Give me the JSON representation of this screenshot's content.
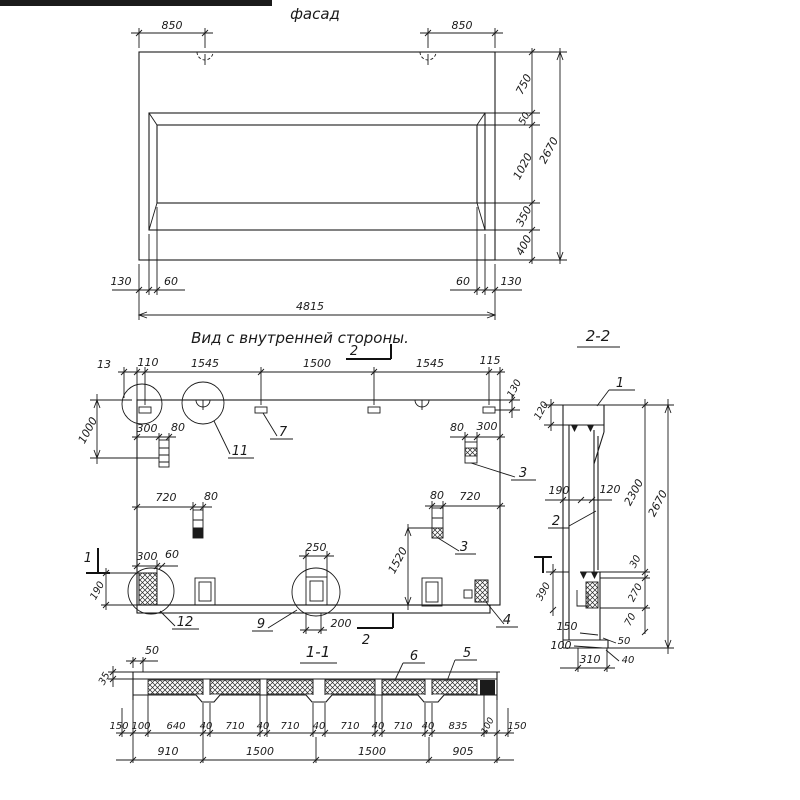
{
  "facade": {
    "title": "фасад",
    "dim_850_left": "850",
    "dim_850_right": "850",
    "chain": {
      "v750": "750",
      "v50": "50",
      "v1020": "1020",
      "v350": "350",
      "v400": "400"
    },
    "height": "2670",
    "bottom": {
      "m130l": "130",
      "r60l": "60",
      "r60r": "60",
      "m130r": "130",
      "width": "4815"
    }
  },
  "inner": {
    "title": "Вид с внутренней стороны.",
    "top_chain": {
      "d13": "13",
      "d110": "110",
      "d1545a": "1545",
      "d1500": "1500",
      "d1545b": "1545",
      "d115": "115"
    },
    "right_130": "130",
    "left_1000": "1000",
    "stud_upper": {
      "d300": "300",
      "d80": "80"
    },
    "stud_mid": {
      "d720": "720",
      "d80": "80"
    },
    "stud_top_right": {
      "d80": "80",
      "d300": "300"
    },
    "stud_mid_right": {
      "d80": "80",
      "d720": "720"
    },
    "v1520": "1520",
    "block_bl": {
      "d300": "300",
      "d60": "60",
      "d190": "190"
    },
    "block_c": {
      "d250": "250",
      "d200": "200"
    },
    "callouts": {
      "c3": "3",
      "c4": "4",
      "c7": "7",
      "c9": "9",
      "c11": "11",
      "c12": "12"
    },
    "marks": {
      "m1": "1",
      "m2": "2"
    }
  },
  "sec22": {
    "title": "2-2",
    "t120": "120",
    "m190": "190",
    "m120": "120",
    "v2300": "2300",
    "v2670": "2670",
    "r30": "30",
    "r270": "270",
    "r70": "70",
    "l390": "390",
    "b150": "150",
    "b100": "100",
    "b310": "310",
    "b50": "50",
    "b40": "40",
    "callouts": {
      "c1": "1",
      "c2": "2"
    }
  },
  "sec11": {
    "title": "1-1",
    "callouts": {
      "c5": "5",
      "c6": "6"
    },
    "t50": "50",
    "l35": "35",
    "row1": [
      "150",
      "100",
      "640",
      "40",
      "710",
      "40",
      "710",
      "40",
      "710",
      "40",
      "710",
      "40",
      "835",
      "100",
      "150"
    ],
    "row2": [
      "910",
      "1500",
      "1500",
      "905"
    ]
  }
}
